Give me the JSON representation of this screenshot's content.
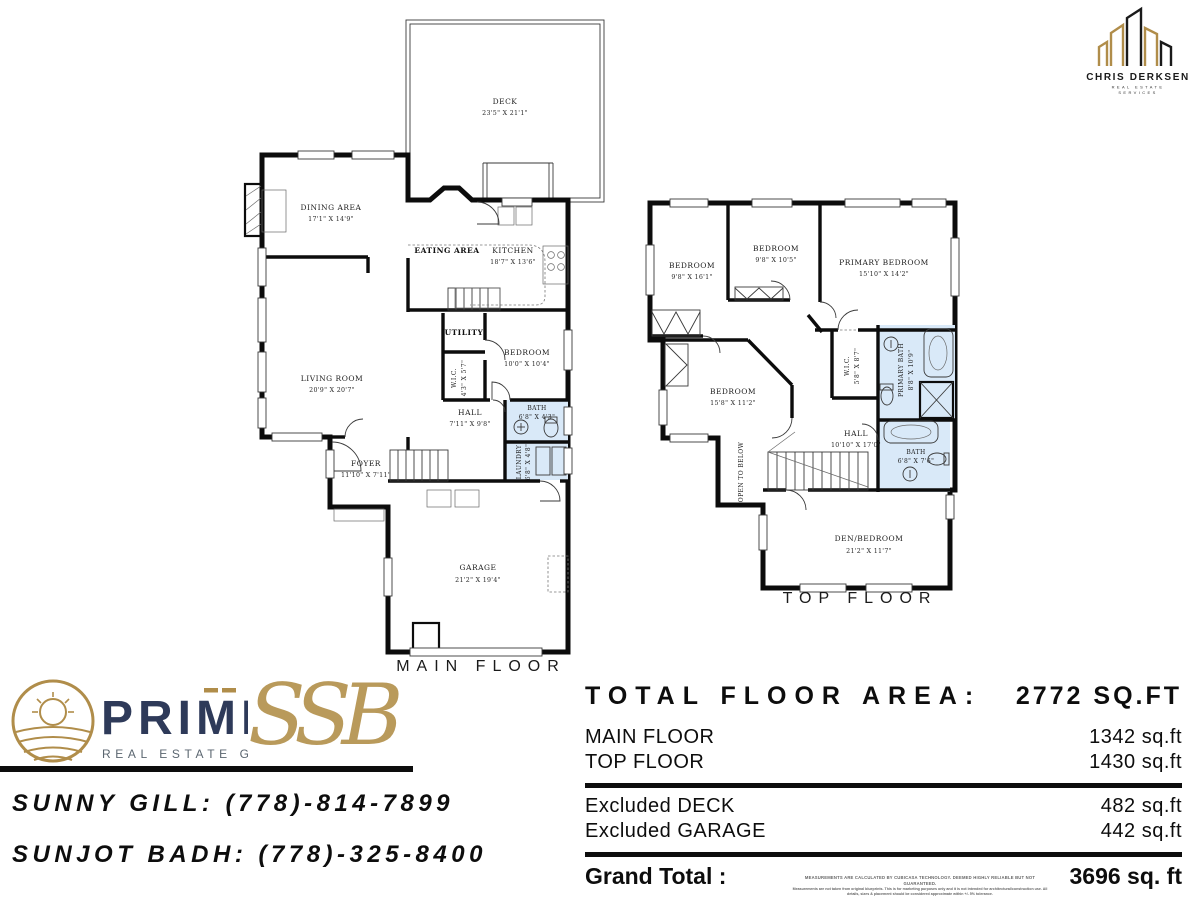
{
  "colors": {
    "wall": "#0c0c0c",
    "bath_fill": "#d9e9f8",
    "gold_accent": "#b08d4a",
    "navy": "#2e3a59"
  },
  "branding": {
    "agent_logo": {
      "name": "CHRIS DERKSEN",
      "tagline_line1": "REAL ESTATE",
      "tagline_line2": "SERVICES"
    },
    "prime_logo": {
      "name": "PRIME",
      "tagline": "REAL ESTATE GROUP"
    },
    "ssb_monogram": "SSB"
  },
  "contacts": [
    {
      "label": "SUNNY GILL: (778)-814-7899"
    },
    {
      "label": "SUNJOT BADH: (778)-325-8400"
    }
  ],
  "area_summary": {
    "title": "TOTAL FLOOR AREA:",
    "total": "2772 SQ.FT",
    "rows": [
      {
        "label": "MAIN FLOOR",
        "value": "1342 sq.ft"
      },
      {
        "label": "TOP FLOOR",
        "value": "1430 sq.ft"
      }
    ],
    "excluded_rows": [
      {
        "label": "Excluded DECK",
        "value": "482 sq.ft"
      },
      {
        "label": "Excluded GARAGE",
        "value": "442 sq.ft"
      }
    ],
    "grand_total_label": "Grand Total  :",
    "grand_total_value": "3696 sq. ft",
    "disclaimer_line1": "MEASUREMENTS ARE CALCULATED BY CUBICASA TECHNOLOGY. DEEMED HIGHLY RELIABLE BUT NOT GUARANTEED.",
    "disclaimer_line2": "Measurements are not taken from original blueprints. This is for marketing purposes only and it is not intended for architectural/construction use. All details, sizes & placement should be considered approximate within +/- 5% tolerance."
  },
  "main_floor": {
    "label": "MAIN FLOOR",
    "rooms": {
      "deck": {
        "name": "DECK",
        "dims": "23'5\" X 21'1\""
      },
      "dining": {
        "name": "DINING AREA",
        "dims": "17'1\" X 14'9\""
      },
      "eating": {
        "name": "EATING AREA"
      },
      "kitchen": {
        "name": "KITCHEN",
        "dims": "18'7\" X 13'6\""
      },
      "living": {
        "name": "LIVING ROOM",
        "dims": "20'9\" X 20'7\""
      },
      "utility": {
        "name": "UTILITY"
      },
      "wic": {
        "name": "W.I.C.",
        "dims": "4'3\" X 5'7\""
      },
      "bedroom": {
        "name": "BEDROOM",
        "dims": "10'0\" X 10'4\""
      },
      "hall": {
        "name": "HALL",
        "dims": "7'11\" X 9'8\""
      },
      "bath": {
        "name": "BATH",
        "dims": "6'8\" X 4'3\""
      },
      "laundry": {
        "name": "LAUNDRY",
        "dims": "6'8\" X 4'8\""
      },
      "foyer": {
        "name": "FOYER",
        "dims": "11'10\" X 7'11\""
      },
      "garage": {
        "name": "GARAGE",
        "dims": "21'2\" X 19'4\""
      }
    }
  },
  "top_floor": {
    "label": "TOP FLOOR",
    "rooms": {
      "bedroom_left": {
        "name": "BEDROOM",
        "dims": "9'8\" X 16'1\""
      },
      "bedroom_mid": {
        "name": "BEDROOM",
        "dims": "9'8\" X 10'5\""
      },
      "primary_bedroom": {
        "name": "PRIMARY BEDROOM",
        "dims": "15'10\" X 14'2\""
      },
      "bedroom_lower": {
        "name": "BEDROOM",
        "dims": "15'8\" X 11'2\""
      },
      "wic": {
        "name": "W.I.C.",
        "dims": "5'8\" X 8'7\""
      },
      "primary_bath": {
        "name": "PRIMARY BATH",
        "dims": "8'8\" X 10'9\""
      },
      "hall": {
        "name": "HALL",
        "dims": "10'10\" X 17'0\""
      },
      "bath": {
        "name": "BATH",
        "dims": "6'8\" X 7'6\""
      },
      "den_bedroom": {
        "name": "DEN/BEDROOM",
        "dims": "21'2\" X 11'7\""
      },
      "open_to_below": {
        "name": "OPEN TO BELOW"
      }
    }
  }
}
